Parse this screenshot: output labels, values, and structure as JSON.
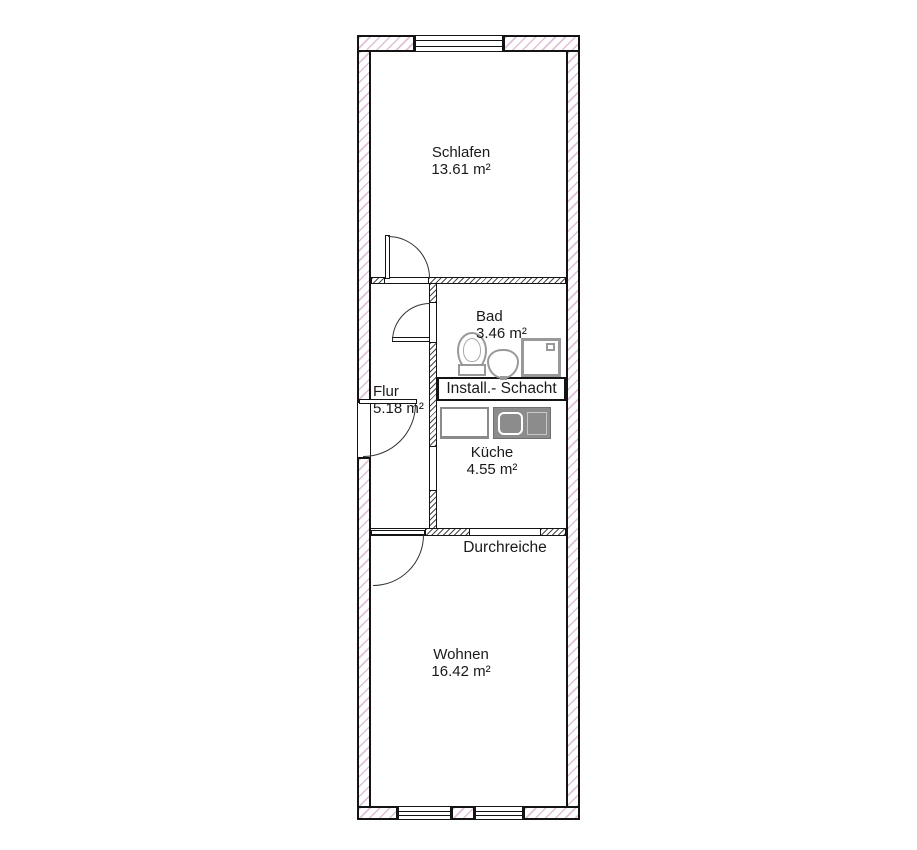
{
  "plan": {
    "type": "apartment-floor-plan",
    "language": "de"
  },
  "rooms": [
    {
      "id": "schlafen",
      "name": "Schlafen",
      "area": "13.61 m²"
    },
    {
      "id": "bad",
      "name": "Bad",
      "area": "3.46 m²"
    },
    {
      "id": "flur",
      "name": "Flur",
      "area": "5.18 m²"
    },
    {
      "id": "kueche",
      "name": "Küche",
      "area": "4.55 m²"
    },
    {
      "id": "wohnen",
      "name": "Wohnen",
      "area": "16.42 m²"
    }
  ],
  "labels": {
    "schacht": "Install.- Schacht",
    "durchreiche": "Durchreiche"
  },
  "fixtures": [
    "toilet",
    "bathroom-sink",
    "shower",
    "stove",
    "kitchen-sink"
  ],
  "colors": {
    "wall_hatch": "#dfc0d6",
    "wall_outline": "#141414",
    "interior_hatch": "#4a4a4a",
    "fixture_gray": "#999999",
    "text": "#1a1a1a",
    "background": "#ffffff"
  }
}
